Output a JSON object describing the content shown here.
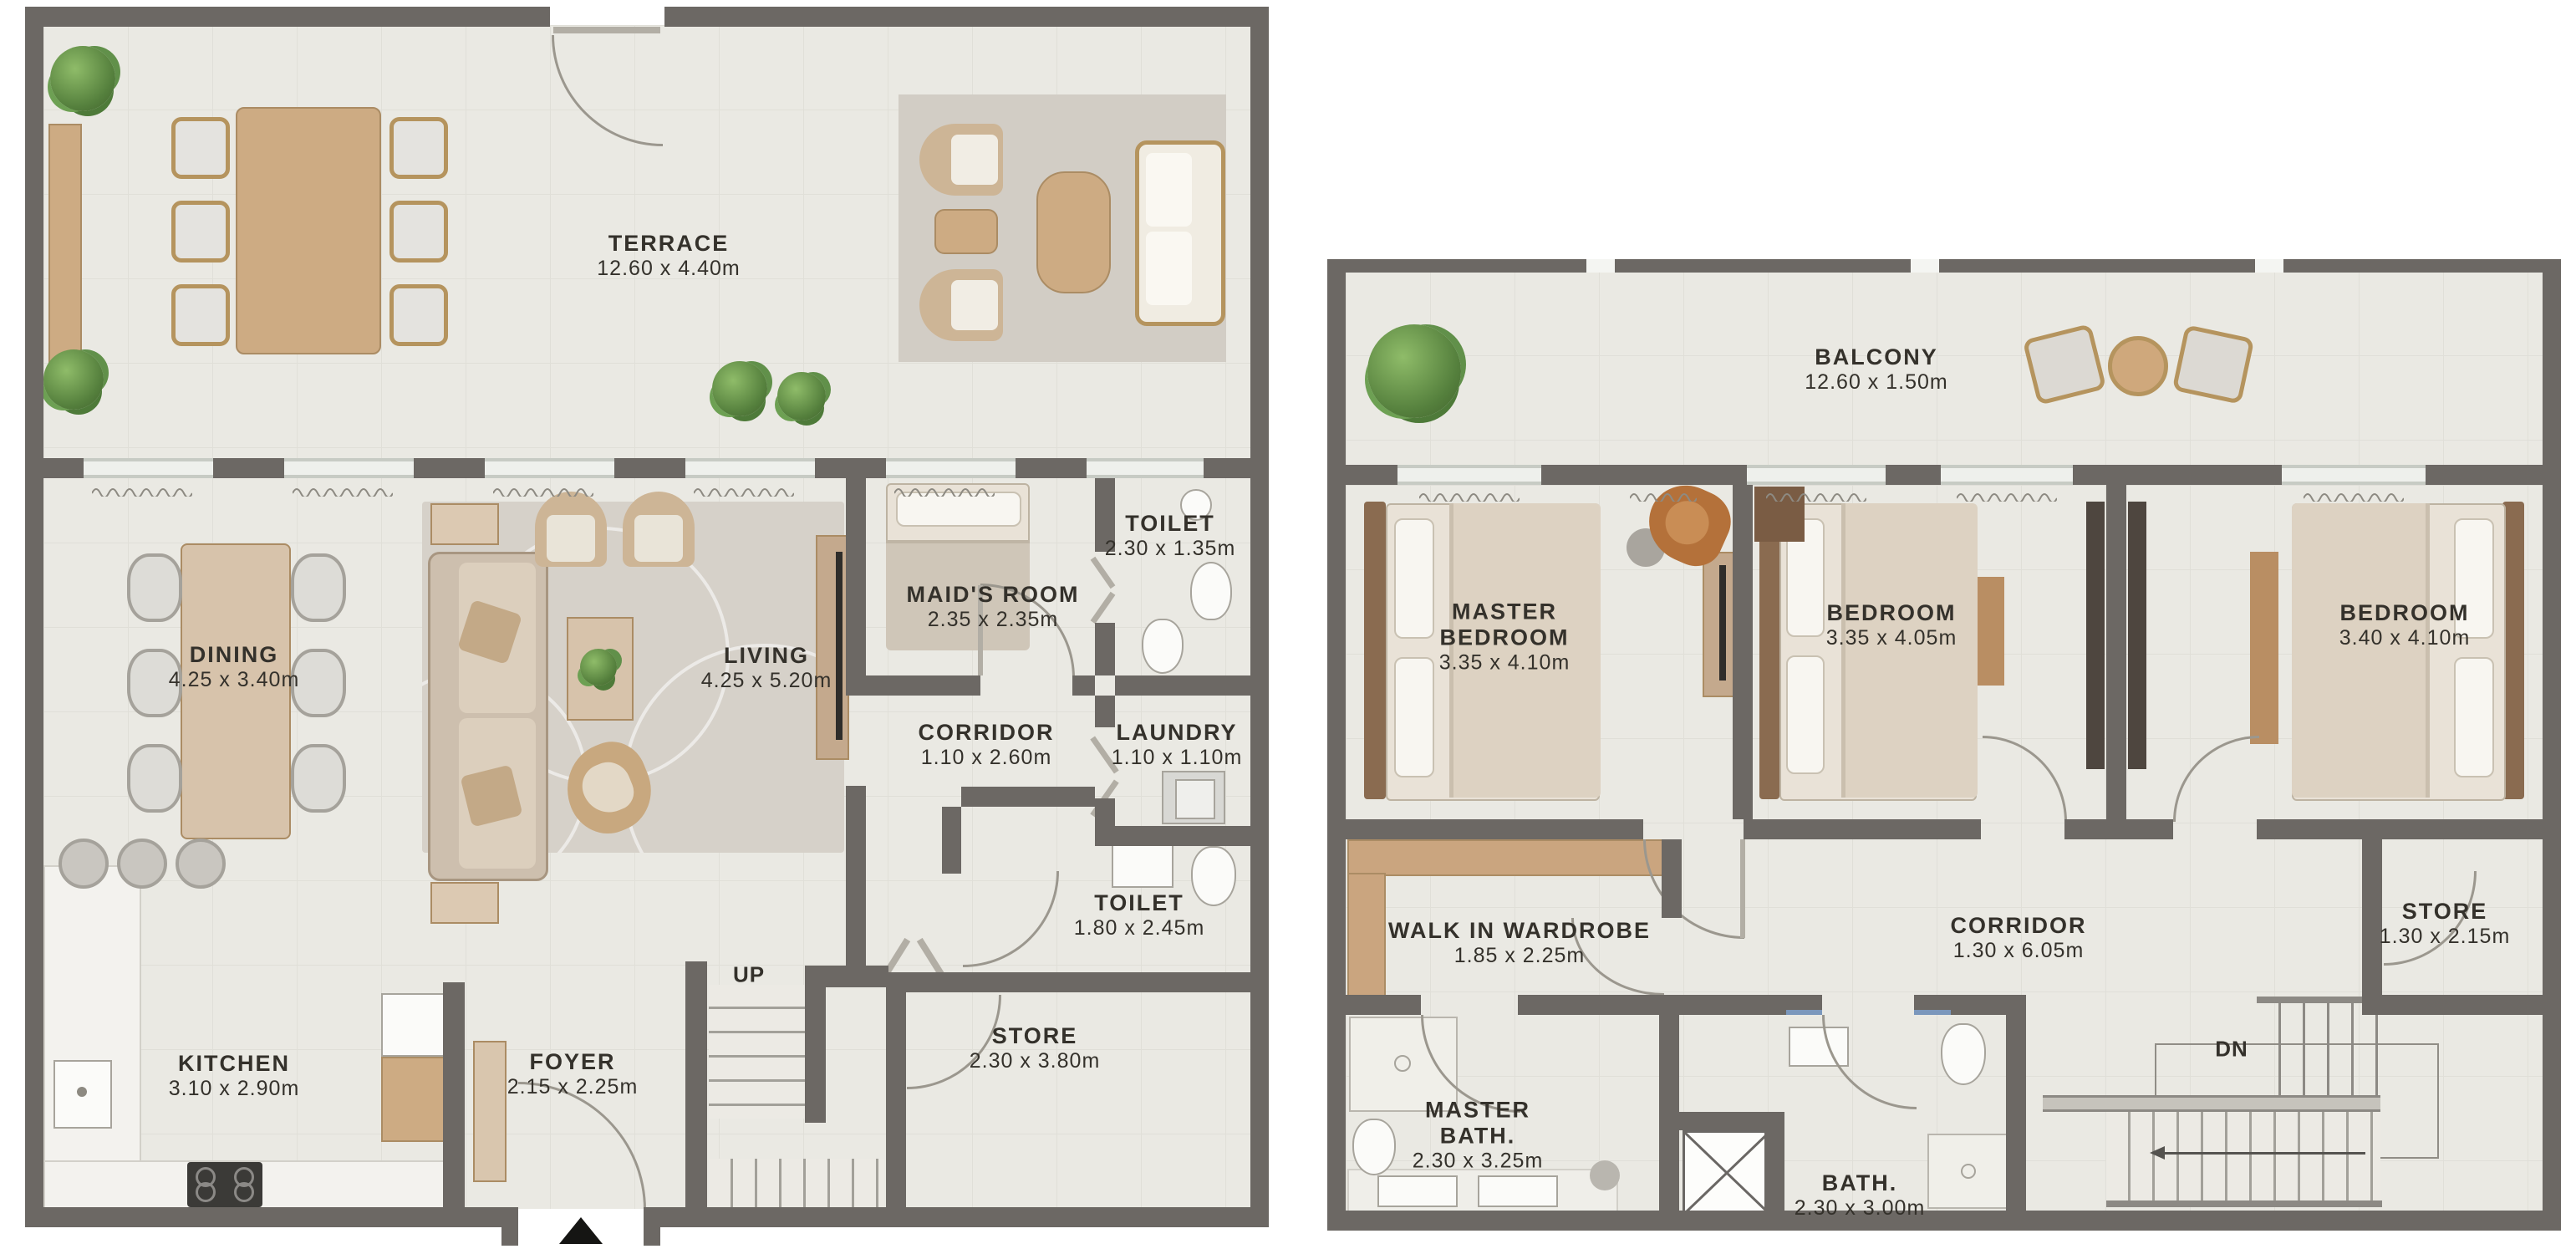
{
  "ground_floor": {
    "title": "ground-floor-plan",
    "rooms": [
      {
        "name": "TERRACE",
        "dims": "12.60 x 4.40m"
      },
      {
        "name": "DINING",
        "dims": "4.25 x 3.40m"
      },
      {
        "name": "LIVING",
        "dims": "4.25 x 5.20m"
      },
      {
        "name": "MAID'S ROOM",
        "dims": "2.35 x 2.35m"
      },
      {
        "name": "TOILET",
        "dims": "2.30 x 1.35m"
      },
      {
        "name": "CORRIDOR",
        "dims": "1.10 x 2.60m"
      },
      {
        "name": "LAUNDRY",
        "dims": "1.10 x 1.10m"
      },
      {
        "name": "TOILET",
        "dims": "1.80 x 2.45m"
      },
      {
        "name": "STORE",
        "dims": "2.30 x 3.80m"
      },
      {
        "name": "KITCHEN",
        "dims": "3.10 x 2.90m"
      },
      {
        "name": "FOYER",
        "dims": "2.15 x 2.25m"
      }
    ],
    "stair_label": "UP"
  },
  "upper_floor": {
    "title": "upper-floor-plan",
    "rooms": [
      {
        "name": "BALCONY",
        "dims": "12.60 x 1.50m"
      },
      {
        "name": "MASTER BEDROOM",
        "dims": "3.35 x 4.10m"
      },
      {
        "name": "BEDROOM",
        "dims": "3.35 x 4.05m"
      },
      {
        "name": "BEDROOM",
        "dims": "3.40 x 4.10m"
      },
      {
        "name": "WALK IN WARDROBE",
        "dims": "1.85 x 2.25m"
      },
      {
        "name": "CORRIDOR",
        "dims": "1.30 x 6.05m"
      },
      {
        "name": "STORE",
        "dims": "1.30 x 2.15m"
      },
      {
        "name": "MASTER BATH.",
        "dims": "2.30 x 3.25m"
      },
      {
        "name": "BATH.",
        "dims": "2.30 x 3.00m"
      }
    ],
    "stair_label": "DN"
  },
  "colors": {
    "wall": "#6c6864",
    "floor": "#eae9e3",
    "wood": "#cdab83",
    "plant": "#55803d"
  }
}
